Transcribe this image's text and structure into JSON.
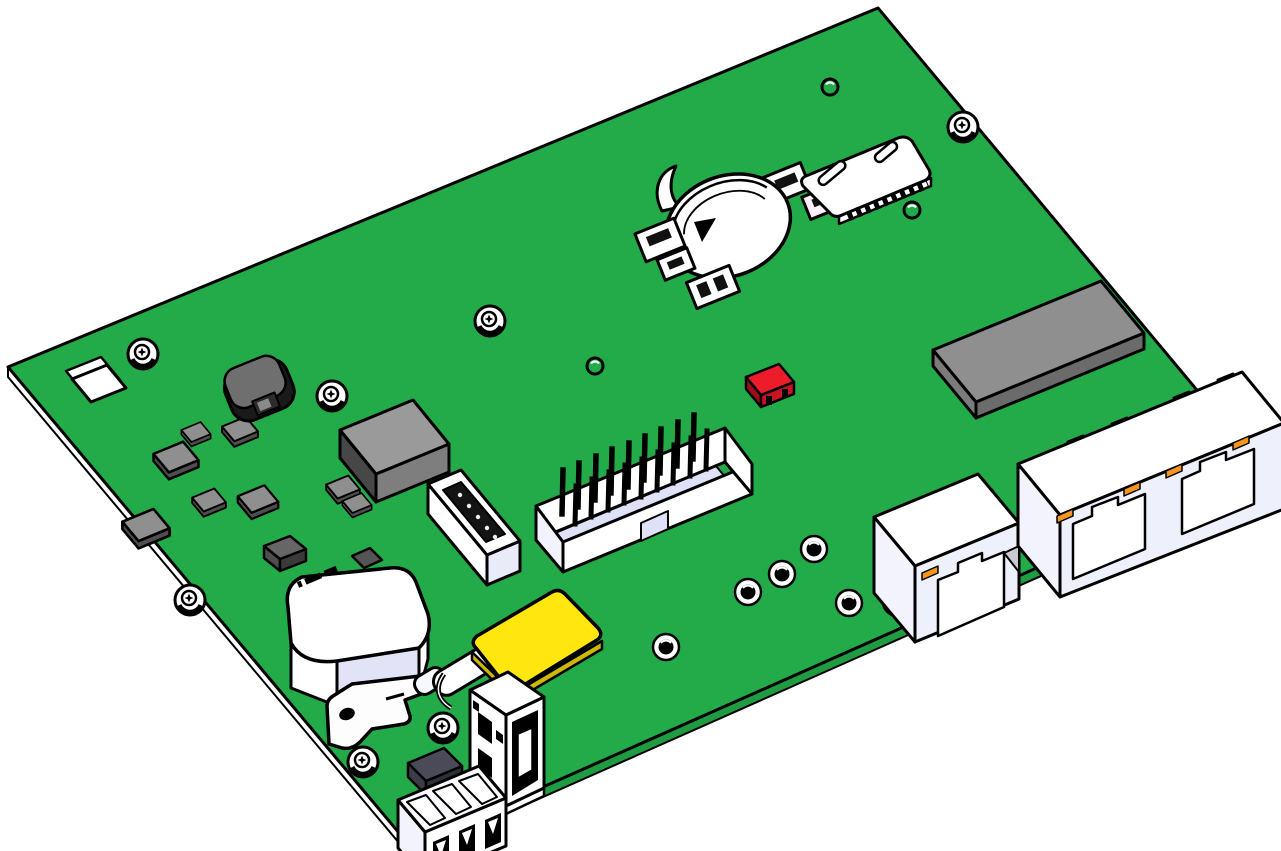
{
  "scene": {
    "kind": "pcb-assembly-cad-render",
    "background": "#ffffff"
  },
  "colors": {
    "background": "#ffffff",
    "board_green": "#23ab4a",
    "board_edge_green": "#1f9c41",
    "outline": "#000000",
    "component_white": "#ffffff",
    "component_shadow": "#f2f3fc",
    "lavender": "#e2e3f7",
    "port_face": "#eef0fb",
    "floor_lavender": "#dfe2f6",
    "chip_gray": "#8f8f8f",
    "chip_side": "#4f4f4f",
    "ic_top": "#9a9a9a",
    "ic_side": "#474747",
    "ic_front": "#7e7e7e",
    "module_top": "#8f8f8f",
    "module_front": "#6b6b6b",
    "module_side": "#7b7b7b",
    "inductor_body": "#1a1a1a",
    "inductor_top": "#6f6f6f",
    "red_top": "#ec1c2b",
    "red_front": "#c51422",
    "red_side": "#9c0e18",
    "yellow_top": "#ffe60e",
    "yellow_edge": "#cdb707",
    "orange_contact": "#f7941d",
    "dark_block": "#4a4a58",
    "dark_block_front": "#2f2f3a",
    "dark_block_side": "#3c3c48",
    "slot_black": "#141414",
    "metal_light": "#dfe1ee",
    "tri_shadow": "#c9c9cf"
  },
  "components": {
    "pcb_board": {
      "label": "green circuit board"
    },
    "corner_cutout": {
      "label": "square cutout hole"
    },
    "mounting_holes": {
      "count": 8
    },
    "solder_pads": {
      "count": 5
    },
    "vias": {
      "count": 3
    },
    "smd_chips": {
      "count": 8
    },
    "ferrite_bead": {
      "label": "black round inductor"
    },
    "main_ic": {
      "label": "large gray chip"
    },
    "coin_cell_holder": {
      "label": "battery retainer clip"
    },
    "sim_card_slot": {
      "label": "sim socket with pins"
    },
    "red_jumper": {
      "label": "small red component"
    },
    "rf_module": {
      "label": "flat gray module"
    },
    "idc_box_header": {
      "label": "shrouded pin header"
    },
    "female_header": {
      "label": "white header with black slot"
    },
    "memory_card": {
      "label": "yellow card"
    },
    "relay_module": {
      "label": "large white component"
    },
    "metal_bracket": {
      "label": "flat bracket with hole"
    },
    "usb_port": {
      "label": "usb-a shell on board edge"
    },
    "terminal_block": {
      "label": "3-position terminal",
      "positions": 3
    },
    "rj45_single": {
      "label": "single ethernet jack"
    },
    "rj45_dual": {
      "label": "dual ethernet jack"
    },
    "standoff_screw": {
      "label": "metal standoff"
    }
  }
}
